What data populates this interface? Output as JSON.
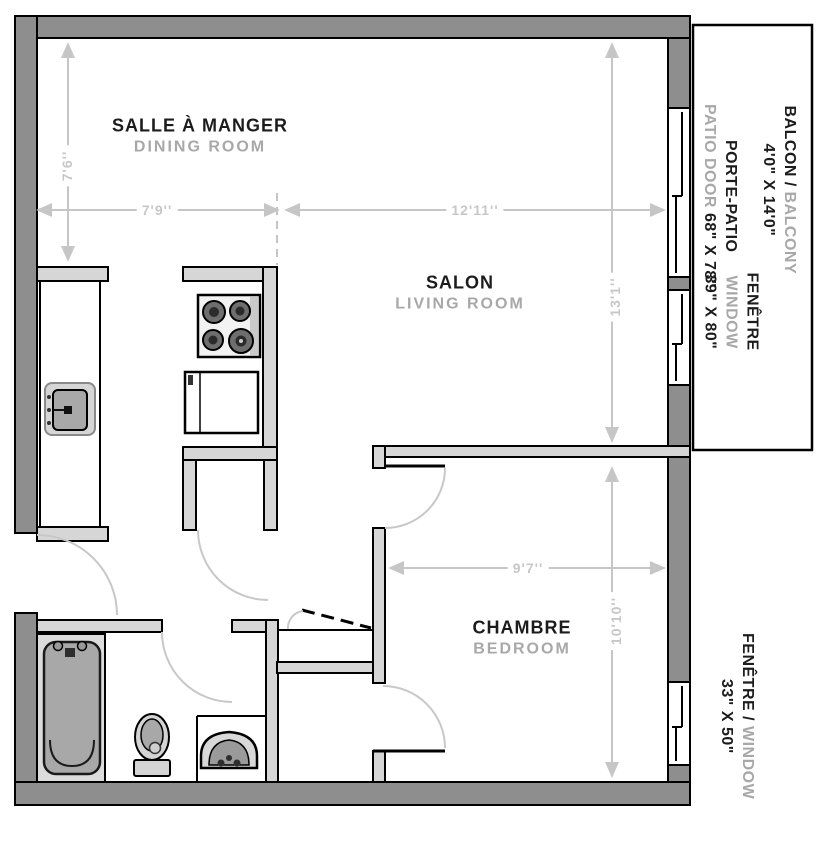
{
  "plan_title": "apartment-floor-plan",
  "rooms": {
    "dining": {
      "fr": "SALLE À MANGER",
      "en": "DINING ROOM"
    },
    "living": {
      "fr": "SALON",
      "en": "LIVING ROOM"
    },
    "bedroom": {
      "fr": "CHAMBRE",
      "en": "BEDROOM"
    }
  },
  "features": {
    "balcony": {
      "fr": "BALCON /",
      "en": "BALCONY",
      "size": "4'0\" X 14'0\""
    },
    "patio_door": {
      "fr": "PORTE-PATIO",
      "en": "PATIO DOOR",
      "size": "68\" X 78\""
    },
    "window_living": {
      "fr": "FENÊTRE",
      "en": "WINDOW",
      "size": "39\" X 80\""
    },
    "window_bedroom": {
      "fr": "FENÊTRE /",
      "en": "WINDOW",
      "size": "33\" X 50\""
    }
  },
  "dimensions": {
    "dining": {
      "width": "7'9''",
      "depth": "7'6''"
    },
    "living": {
      "width": "12'11''",
      "depth": "13'1''"
    },
    "bedroom": {
      "width": "9'7''",
      "depth": "10'10''"
    }
  },
  "fixtures": {
    "kitchen": [
      "stove",
      "refrigerator",
      "sink",
      "counter"
    ],
    "bathroom": [
      "bathtub",
      "toilet",
      "sink"
    ]
  },
  "architecture": {
    "doors": [
      "entry-door",
      "kitchen-pantry-door",
      "bathroom-door",
      "bedroom-door",
      "bedroom-closet-door",
      "hall-closet-bifold-door",
      "sliding-patio-door"
    ],
    "windows": [
      "living-room-window",
      "bedroom-window"
    ]
  },
  "colors": {
    "outer_wall": "#8e8e8e",
    "interior_wall": "#d6d6d6",
    "dimension_gray": "#c6c6c6",
    "english_label_gray": "#a8a8a8",
    "french_label_black": "#1c1c1c",
    "background": "#ffffff"
  }
}
